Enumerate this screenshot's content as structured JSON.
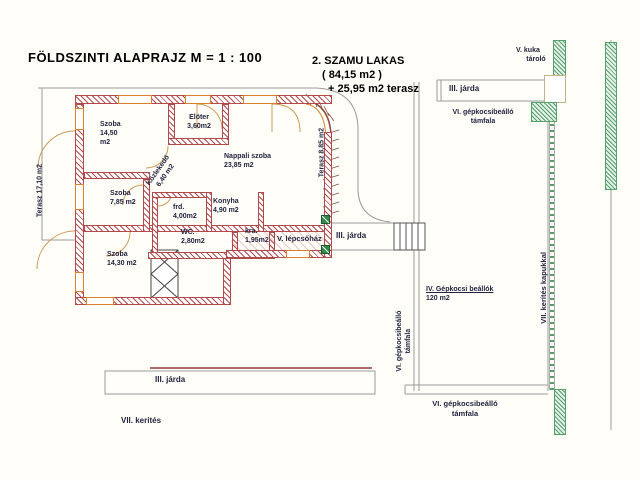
{
  "title": "FÖLDSZINTI  ALAPRAJZ   M = 1 : 100",
  "note": {
    "line1": "2. SZAMU  LAKAS",
    "line2": "( 84,15  m2 )",
    "line3": "+ 25,95  m2 terasz"
  },
  "rooms": {
    "szoba1": {
      "name": "Szoba",
      "area": "14,50",
      "unit": "m2"
    },
    "eloter": {
      "name": "Elöter",
      "area": "3,60m2"
    },
    "nappali": {
      "name": "Nappali szoba",
      "area": "23,85 m2"
    },
    "szoba2": {
      "name": "Szoba",
      "area": "7,85 m2"
    },
    "kozlekedo": {
      "name": "Közlekedő",
      "area": "6,40 m2"
    },
    "furdo": {
      "name": "frd.",
      "area": "4,00m2"
    },
    "wc": {
      "name": "WC.",
      "area": "2,80m2"
    },
    "konyha": {
      "name": "Konyha",
      "area": "4,90 m2"
    },
    "kamra": {
      "name": "kra.",
      "area": "1,95m2"
    },
    "szoba3": {
      "name": "Szoba",
      "area": "14,30  m2"
    },
    "lepcsohaz": {
      "name": "V. lépcsőház"
    }
  },
  "terraces": {
    "left": "Terasz 17,10 m2",
    "right": "Terasz 8,85 m2"
  },
  "site": {
    "kuka_line1": "V. kuka",
    "kuka_line2": "tároló",
    "jarda_top": "III. járda",
    "tamfala_top_line1": "VI. gépkocsibeálló",
    "tamfala_top_line2": "támfala",
    "jarda_mid": "III. járda",
    "parking_line1": "IV. Gépkocsi beállók",
    "parking_line2": "120 m2",
    "tamfala_vert_line1": "VI. gépkocsibeálló",
    "tamfala_vert_line2": "támfala",
    "kerites_vert": "VII. kerítés kapukkal",
    "jarda_bottom": "III. járda",
    "kerites_bottom": "VII. kerités",
    "tamfala_bottom_line1": "VI. gépkocsibeálló",
    "tamfala_bottom_line2": "támfala"
  },
  "colors": {
    "wall": "#b24a4a",
    "frame": "#d9822b",
    "green": "#55a06b",
    "label": "#23233f",
    "line": "#9a9a9a"
  }
}
